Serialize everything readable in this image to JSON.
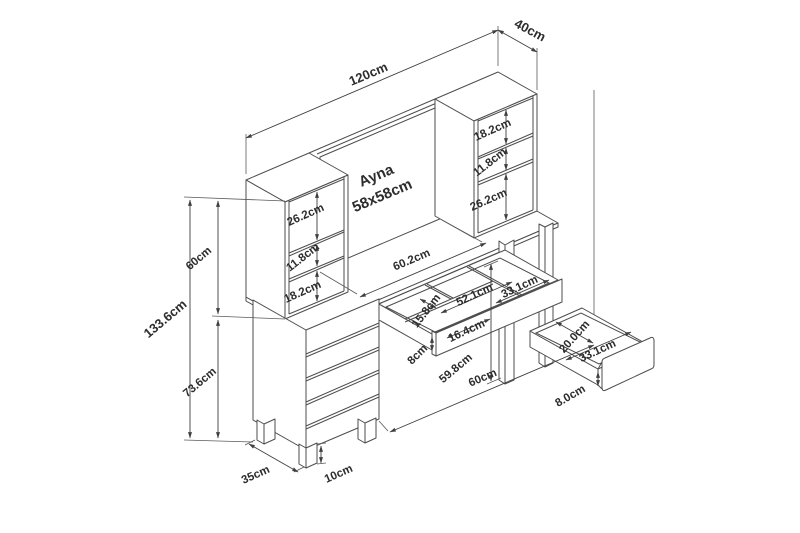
{
  "diagram_labels": {
    "total_width": "120cm",
    "total_depth": "40cm",
    "mirror_line1": "Ayna",
    "mirror_line2": "58x58cm",
    "left_shelf_top": "26.2cm",
    "left_shelf_middle": "11.8cm",
    "left_shelf_bottom": "18.2cm",
    "right_shelf_top": "18.2cm",
    "right_shelf_middle": "11.8cm",
    "right_shelf_bottom": "26.2cm",
    "hutch_height": "60cm",
    "total_height": "133.6cm",
    "table_height": "73.6cm",
    "desktop_span": "60.2cm",
    "tray_depth": "15.8cm",
    "tray_front_width": "52.1cm",
    "tray_right_width": "33.1cm",
    "tray_small_width": "16.4cm",
    "middle_drawer_height": "8cm",
    "leg_clearance_height": "59.8cm",
    "right_drawer_depth": "20.0cm",
    "right_drawer_width": "33.1cm",
    "right_drawer_height": "8.0cm",
    "base_width": "60cm",
    "base_depth": "35cm",
    "foot_height": "10cm"
  },
  "style": {
    "line_color": "#4d4d4d",
    "text_color": "#2d2d2d",
    "background": "#ffffff"
  }
}
